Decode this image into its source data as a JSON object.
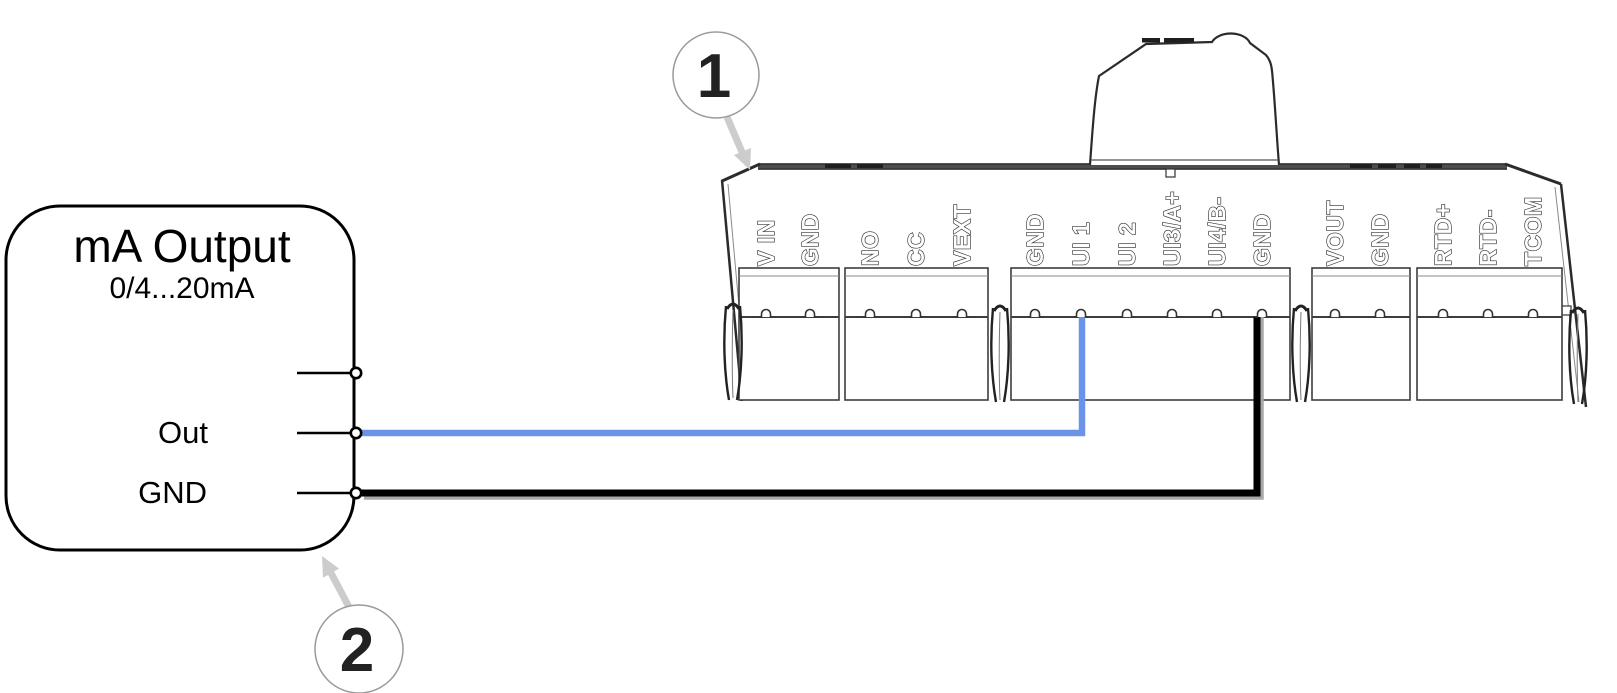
{
  "source_box": {
    "title": "mA Output",
    "subtitle": "0/4...20mA",
    "pin_labels": [
      "",
      "Out",
      "GND"
    ]
  },
  "device": {
    "terminal_labels": [
      "V IN",
      "GND",
      "NO",
      "CC",
      "VEXT",
      "GND",
      "UI 1",
      "UI 2",
      "UI3/A+",
      "UI4/B-",
      "GND",
      "VOUT",
      "GND",
      "RTD+",
      "RTD-",
      "TCOM"
    ]
  },
  "callouts": [
    {
      "number": "1"
    },
    {
      "number": "2"
    }
  ],
  "wires": [
    {
      "name": "signal-wire",
      "color": "#6b94e9",
      "from": "mA Output: Out",
      "to": "Device terminal: UI 1"
    },
    {
      "name": "ground-wire",
      "color": "#000000",
      "from": "mA Output: GND",
      "to": "Device terminal: GND"
    }
  ]
}
